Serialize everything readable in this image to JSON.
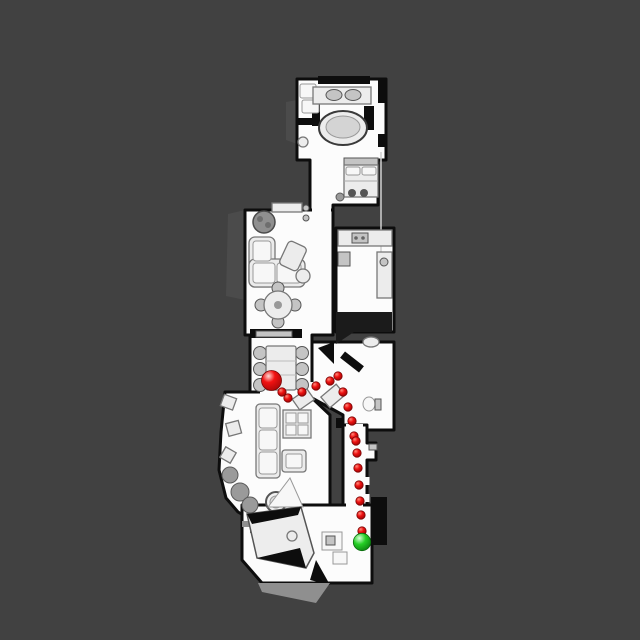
{
  "scene": {
    "description": "Top-down robot navigation floorplan map of a narrow apartment on a dark gray canvas, with a planned path of red dots from a red start sphere to a green goal sphere",
    "background_color": "#414141",
    "map": {
      "floor_color": "#fcfcfc",
      "wall_color": "#0d0d0d",
      "furniture_color": "#ececec"
    }
  },
  "path": {
    "color": "#e01212",
    "dot_edge_color": "#7d0404",
    "dot_radius": 4.2,
    "waypoints": [
      [
        282,
        392
      ],
      [
        288,
        398
      ],
      [
        302,
        392
      ],
      [
        316,
        386
      ],
      [
        330,
        381
      ],
      [
        338,
        376
      ],
      [
        343,
        392
      ],
      [
        348,
        407
      ],
      [
        352,
        421
      ],
      [
        354,
        436
      ],
      [
        356,
        441
      ],
      [
        357,
        453
      ],
      [
        358,
        468
      ],
      [
        359,
        485
      ],
      [
        360,
        501
      ],
      [
        361,
        515
      ],
      [
        362,
        531
      ]
    ]
  },
  "markers": {
    "start": {
      "label": "start",
      "x": 271.5,
      "y": 380.5,
      "radius": 10,
      "color": "#e01212"
    },
    "goal": {
      "label": "goal",
      "x": 362,
      "y": 542,
      "radius": 8.7,
      "color": "#22c522"
    }
  }
}
